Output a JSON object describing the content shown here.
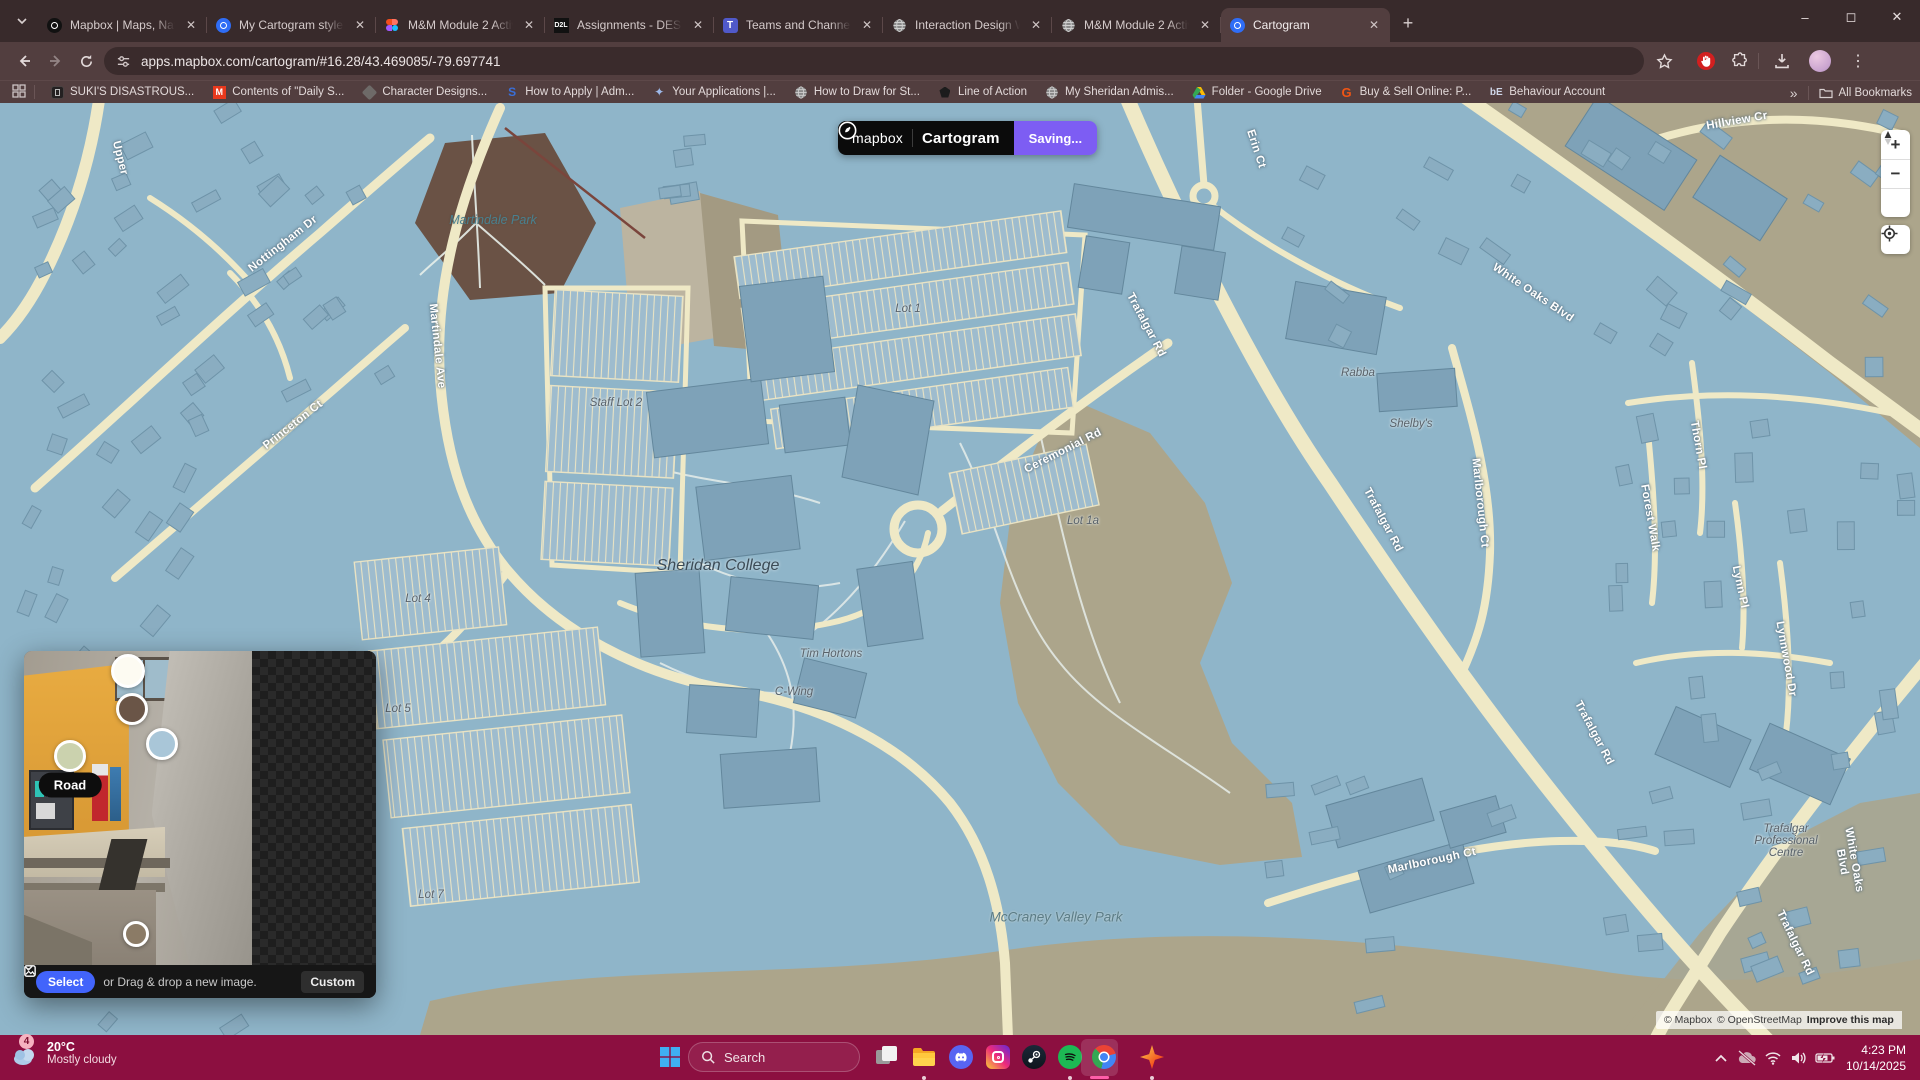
{
  "browser": {
    "tabs": [
      {
        "title": "Mapbox | Maps, Navigatio",
        "icon": "mapbox-dark",
        "active": false
      },
      {
        "title": "My Cartogram style | Map",
        "icon": "mapbox-blue",
        "active": false
      },
      {
        "title": "M&M Module 2 Activity 1",
        "icon": "figma",
        "active": false
      },
      {
        "title": "Assignments - DESN2742",
        "icon": "d2l",
        "active": false
      },
      {
        "title": "Teams and Channels | Gen",
        "icon": "teams",
        "active": false
      },
      {
        "title": "Interaction Design Week",
        "icon": "globe",
        "active": false
      },
      {
        "title": "M&M Module 2 Activity 1",
        "icon": "globe",
        "active": false
      },
      {
        "title": "Cartogram",
        "icon": "mapbox-blue",
        "active": true
      }
    ],
    "new_tab_label": "+",
    "address": "apps.mapbox.com/cartogram/#16.28/43.469085/-79.697741",
    "bookmarks": [
      {
        "label": "SUKI'S DISASTROUS...",
        "icon": "dark-app"
      },
      {
        "label": "Contents of \"Daily S...",
        "icon": "orange-m"
      },
      {
        "label": "Character Designs...",
        "icon": "gray-cube"
      },
      {
        "label": "How to Apply | Adm...",
        "icon": "blue-s"
      },
      {
        "label": "Your Applications |...",
        "icon": "sparkle"
      },
      {
        "label": "How to Draw for St...",
        "icon": "globe"
      },
      {
        "label": "Line of Action",
        "icon": "dark-brush"
      },
      {
        "label": "My Sheridan Admis...",
        "icon": "globe"
      },
      {
        "label": "Folder - Google Drive",
        "icon": "drive"
      },
      {
        "label": "Buy & Sell Online: P...",
        "icon": "kijiji"
      },
      {
        "label": "Behaviour Account",
        "icon": "be"
      }
    ],
    "bookmarks_overflow": "»",
    "all_bookmarks_label": "All Bookmarks"
  },
  "cartogram": {
    "brand": "mapbox",
    "app_name": "Cartogram",
    "status": "Saving...",
    "panel": {
      "select_label": "Select",
      "drop_hint": "or Drag & drop a new image.",
      "style_dropdown": "Custom",
      "road_tooltip": "Road",
      "swatches": [
        {
          "name": "swatch-1",
          "color": "#FDFBF2",
          "x": 104,
          "y": 20,
          "r": 17
        },
        {
          "name": "swatch-2",
          "color": "#6A5547",
          "x": 108,
          "y": 58,
          "r": 16
        },
        {
          "name": "swatch-3",
          "color": "#A9C6D8",
          "x": 138,
          "y": 93,
          "r": 16
        },
        {
          "name": "swatch-4-road",
          "color": "#CBD2AE",
          "x": 46,
          "y": 105,
          "r": 16
        },
        {
          "name": "swatch-5",
          "color": "#8B7B66",
          "x": 112,
          "y": 283,
          "r": 13
        }
      ]
    },
    "colors": {
      "accent_purple": "#7D5DF3",
      "select_blue": "#4264FB"
    }
  },
  "map": {
    "zoom_in": "+",
    "zoom_out": "−",
    "attribution": {
      "mapbox": "© Mapbox",
      "osm": "© OpenStreetMap",
      "improve": "Improve this map"
    },
    "labels": [
      {
        "kind": "street",
        "text": "Trafalgar Rd",
        "x": 1146,
        "y": 222,
        "r": 62
      },
      {
        "kind": "street",
        "text": "Trafalgar Rd",
        "x": 1383,
        "y": 417,
        "r": 62
      },
      {
        "kind": "street",
        "text": "Trafalgar Rd",
        "x": 1594,
        "y": 630,
        "r": 62
      },
      {
        "kind": "street",
        "text": "Trafalgar Rd",
        "x": 1795,
        "y": 840,
        "r": 64
      },
      {
        "kind": "street",
        "text": "Ceremonial Rd",
        "x": 1063,
        "y": 348,
        "r": -27
      },
      {
        "kind": "street",
        "text": "White Oaks Blvd",
        "x": 1533,
        "y": 190,
        "r": 34
      },
      {
        "kind": "street",
        "text": "White Oaks Blvd",
        "x": 1848,
        "y": 758,
        "r": 80
      },
      {
        "kind": "street",
        "text": "Hillview Cr",
        "x": 1737,
        "y": 18,
        "r": -10
      },
      {
        "kind": "street",
        "text": "Erin Ct",
        "x": 1256,
        "y": 46,
        "r": 72
      },
      {
        "kind": "street",
        "text": "Martindale Ave",
        "x": 437,
        "y": 243,
        "r": 84
      },
      {
        "kind": "street",
        "text": "Nottingham Dr",
        "x": 283,
        "y": 141,
        "r": -38
      },
      {
        "kind": "street",
        "text": "Princeton Ct",
        "x": 293,
        "y": 322,
        "r": -38
      },
      {
        "kind": "street",
        "text": "Upper",
        "x": 120,
        "y": 55,
        "r": 76
      },
      {
        "kind": "street",
        "text": "Marlborough Ct",
        "x": 1480,
        "y": 400,
        "r": 84
      },
      {
        "kind": "street",
        "text": "Marlborough Ct",
        "x": 1432,
        "y": 758,
        "r": -12
      },
      {
        "kind": "street",
        "text": "Thorn Pl",
        "x": 1698,
        "y": 342,
        "r": 80
      },
      {
        "kind": "street",
        "text": "Lynn Pl",
        "x": 1740,
        "y": 484,
        "r": 78
      },
      {
        "kind": "street",
        "text": "Lynnwood Dr",
        "x": 1786,
        "y": 556,
        "r": 80
      },
      {
        "kind": "street",
        "text": "Forest Walk",
        "x": 1650,
        "y": 415,
        "r": 80
      },
      {
        "kind": "poi",
        "text": "Staff Lot 2",
        "x": 616,
        "y": 300,
        "r": 0
      },
      {
        "kind": "poi",
        "text": "Lot 1",
        "x": 908,
        "y": 206,
        "r": 0
      },
      {
        "kind": "poi",
        "text": "Lot 1a",
        "x": 1083,
        "y": 418,
        "r": 0
      },
      {
        "kind": "poi",
        "text": "Lot 4",
        "x": 418,
        "y": 496,
        "r": 0
      },
      {
        "kind": "poi",
        "text": "Lot 5",
        "x": 398,
        "y": 606,
        "r": 0
      },
      {
        "kind": "poi",
        "text": "Lot 7",
        "x": 431,
        "y": 792,
        "r": 0
      },
      {
        "kind": "poi",
        "text": "Tim Hortons",
        "x": 831,
        "y": 551,
        "r": 0
      },
      {
        "kind": "poi",
        "text": "C-Wing",
        "x": 794,
        "y": 589,
        "r": 0
      },
      {
        "kind": "poi",
        "text": "Rabba",
        "x": 1358,
        "y": 270,
        "r": 0
      },
      {
        "kind": "poi",
        "text": "Shelby's",
        "x": 1411,
        "y": 321,
        "r": 0
      },
      {
        "kind": "poi",
        "text": "Trafalgar\nProfessional\nCentre",
        "x": 1786,
        "y": 738,
        "r": 0
      },
      {
        "kind": "place",
        "text": "Sheridan College",
        "x": 718,
        "y": 463,
        "r": 0
      },
      {
        "kind": "park",
        "text": "Martindale Park",
        "x": 493,
        "y": 117,
        "r": 0
      },
      {
        "kind": "area",
        "text": "McCraney Valley Park",
        "x": 1056,
        "y": 814,
        "r": 0
      }
    ]
  },
  "taskbar": {
    "weather": {
      "badge": "4",
      "temp": "20°C",
      "condition": "Mostly cloudy"
    },
    "search_placeholder": "Search",
    "apps": [
      {
        "name": "task-view",
        "icon": "taskview",
        "dot": false
      },
      {
        "name": "file-explorer",
        "icon": "folder",
        "dot": true
      },
      {
        "name": "discord",
        "icon": "discord",
        "dot": false
      },
      {
        "name": "instagram",
        "icon": "instagram",
        "dot": false
      },
      {
        "name": "steam",
        "icon": "steam",
        "dot": false
      },
      {
        "name": "spotify",
        "icon": "spotify",
        "dot": true
      },
      {
        "name": "chrome",
        "icon": "chrome",
        "dot": false,
        "active": true
      },
      {
        "name": "star-app",
        "icon": "starapp",
        "dot": true
      }
    ],
    "tray": {
      "time": "4:23 PM",
      "date": "10/14/2025"
    }
  }
}
